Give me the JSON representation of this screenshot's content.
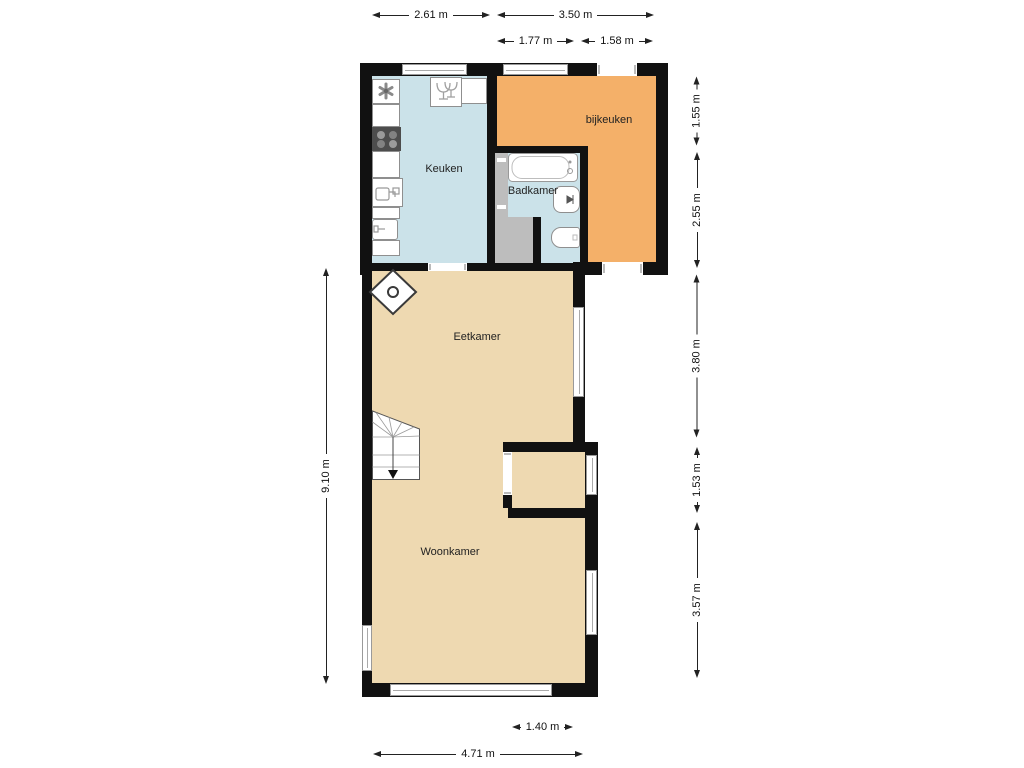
{
  "rooms": {
    "keuken": {
      "label": "Keuken"
    },
    "bijkeuken": {
      "label": "bijkeuken"
    },
    "badkamer": {
      "label": "Badkamer"
    },
    "eetkamer": {
      "label": "Eetkamer"
    },
    "woonkamer": {
      "label": "Woonkamer"
    }
  },
  "dimensions": {
    "top_outer_left": "2.61 m",
    "top_outer_right": "3.50 m",
    "top_inner_left": "1.77 m",
    "top_inner_right": "1.58 m",
    "right_1": "1.55 m",
    "right_2": "2.55 m",
    "right_3": "3.80 m",
    "right_4": "1.53 m",
    "right_5": "3.57 m",
    "left_total": "9.10 m",
    "bottom_window": "1.40 m",
    "bottom_total": "4.71 m"
  },
  "colors": {
    "wall": "#111111",
    "kitchen_bathroom_floor": "#cbe2e9",
    "utility_floor": "#f4b069",
    "living_floor": "#eed9b1",
    "hall_floor": "#bdbdbd"
  },
  "icons": {
    "kitchen": [
      "extractor-fan",
      "stove-4-burners",
      "sink",
      "kitchen-unit",
      "dishwasher"
    ],
    "bathroom": [
      "bathtub",
      "toilet",
      "washbasin"
    ],
    "living": [
      "wood-stove",
      "stairs-down"
    ]
  }
}
